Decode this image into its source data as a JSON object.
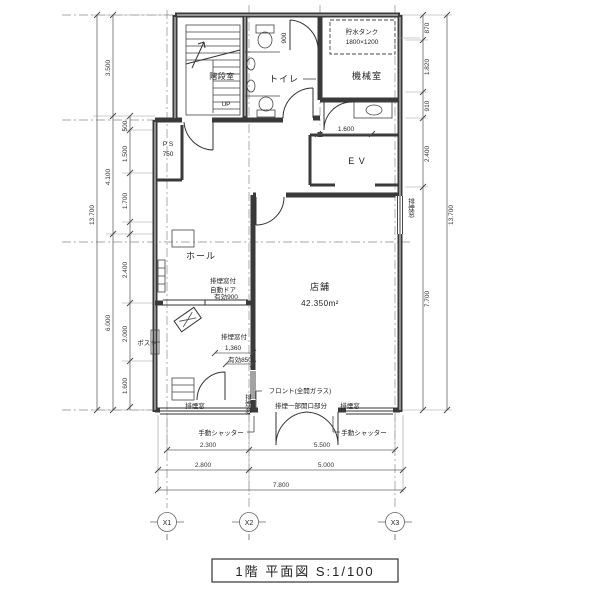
{
  "title": "1階 平面図 S:1/100",
  "rooms": {
    "stairwell": "階段室",
    "up": "UP",
    "toilet": "トイレ",
    "toilet_dim": "900",
    "machine_room": "機械室",
    "tank_name": "貯水タンク",
    "tank_size": "1800×1200",
    "ps": "P S",
    "ps_size": "750",
    "elevator": "E V",
    "elevator_dim": "1.600",
    "hall": "ホール",
    "shop": "店舗",
    "shop_area": "42.350m²",
    "post": "ポスト"
  },
  "annotations": {
    "auto_door": [
      "排煙窓付",
      "自動ドア",
      "有効900"
    ],
    "vestibule_window": [
      "排煙窓付",
      "1,360",
      "有効850"
    ],
    "front": "フロント(全開ガラス)",
    "smoke_window_left": "排煙窓",
    "smoke_opening_center": "排煙一部開口部分",
    "smoke_window_right": "排煙窓",
    "shutter_left": "手動シャッター",
    "shutter_right": "手動シャッター",
    "smoke_window_east_wall": "排煙窓",
    "smoke_window_vestibule": "排煙窓"
  },
  "dimensions": {
    "left_total": "13.700",
    "left_major": [
      "3.500",
      "4.100",
      "6.000"
    ],
    "left_minor": [
      "500",
      "1.500",
      "1.700",
      "2.400",
      "2.000",
      "1.600"
    ],
    "right_minor": [
      "870",
      "1.820",
      "910",
      "2.400",
      "7.700"
    ],
    "right_total": "13.700",
    "bottom_row1": [
      "2.300",
      "5.500"
    ],
    "bottom_row2": [
      "2.800",
      "5.000"
    ],
    "bottom_total": "7.800"
  },
  "grid_labels": [
    "X1",
    "X2",
    "X3"
  ]
}
